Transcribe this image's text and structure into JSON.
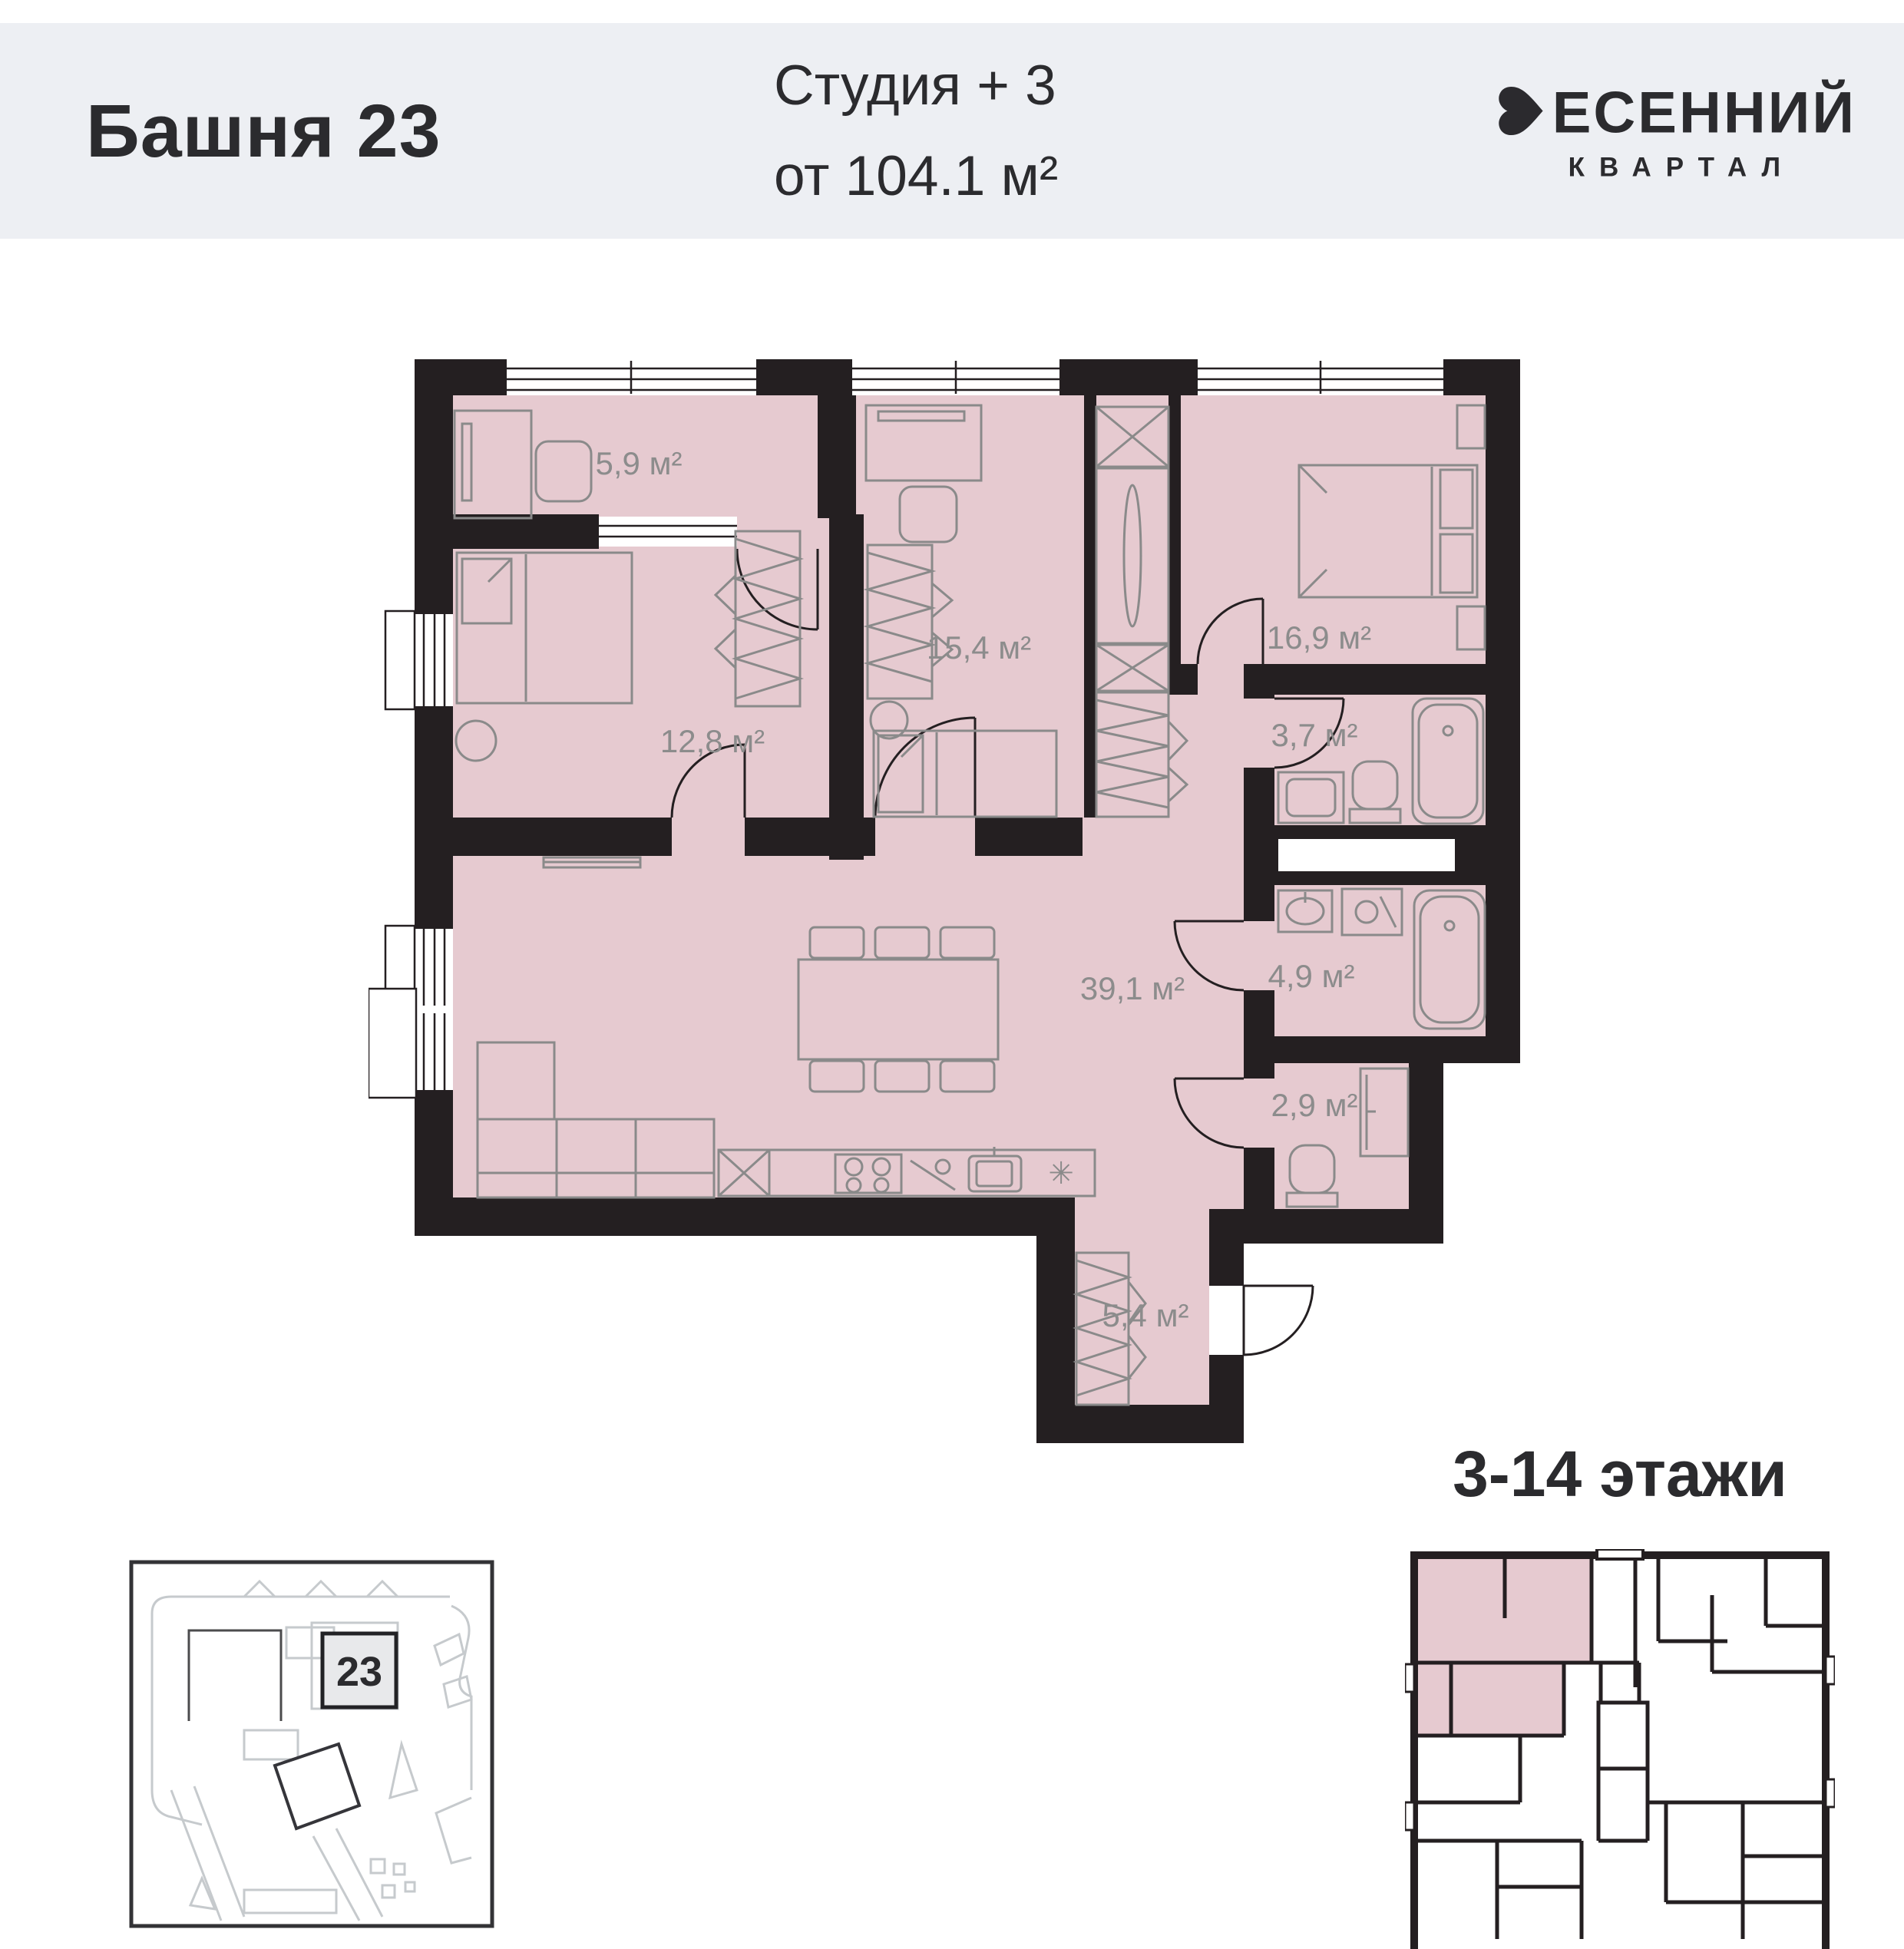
{
  "header": {
    "tower_title": "Башня 23",
    "unit_type": "Студия + 3",
    "unit_area": "от 104.1 м²",
    "brand": {
      "initial": "В",
      "name_rest": "ЕСЕННИЙ",
      "subtitle": "КВАРТАЛ"
    }
  },
  "plan": {
    "rooms": [
      {
        "name": "cabinet",
        "area": "5,9 м²"
      },
      {
        "name": "bedroom-middle",
        "area": "15,4 м²"
      },
      {
        "name": "bedroom-right",
        "area": "16,9 м²"
      },
      {
        "name": "bedroom-left",
        "area": "12,8 м²"
      },
      {
        "name": "shower-room",
        "area": "3,7 м²"
      },
      {
        "name": "living-kitchen",
        "area": "39,1 м²"
      },
      {
        "name": "bathroom",
        "area": "4,9 м²"
      },
      {
        "name": "wc",
        "area": "2,9 м²"
      },
      {
        "name": "hallway",
        "area": "5,4 м²"
      }
    ],
    "fridge_symbol": "✳"
  },
  "site_plan": {
    "building_number": "23"
  },
  "floors_label": "3-14 этажи",
  "colors": {
    "room_fill": "#e6cad0",
    "wall": "#241f21",
    "header_band": "#edeff3",
    "furniture_line": "#8a8a8a",
    "label_text": "#8c8c8c"
  }
}
